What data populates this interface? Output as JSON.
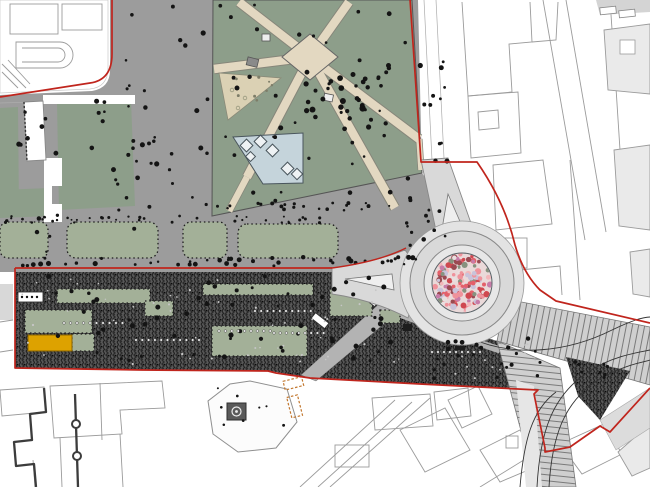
{
  "drawing": {
    "kind": "urban-masterplan-site-plan",
    "width": 650,
    "height": 487
  },
  "palette": {
    "plaza": "#9c9c9c",
    "lawn": "#8d9e8a",
    "panel": "#a3b098",
    "beige": "#e3d8c1",
    "tan": "#dbd1b4",
    "blue": "#c5d4db",
    "road": "#d9d9d9",
    "apron": "#e7e7e7",
    "sidewalk": "#e3e3e3",
    "grove": "#585858",
    "red": "#c0251d",
    "orange": "#dda200",
    "line": "#9b9b9b",
    "dark": "#3c3c3c",
    "pathgray": "#b3b3b3",
    "hatch": "#cfcfcf"
  },
  "roundabout": {
    "cx": 462,
    "cy": 283,
    "r_sidewalk": 62,
    "r_road": 52,
    "r_apron": 38,
    "r_mosaic": 30,
    "mosaic": {
      "seed": 11,
      "count": 155,
      "base": "#ead9d9",
      "colors": [
        "#e4606a",
        "#ef929b",
        "#cf4850",
        "#c9c3da",
        "#87927f",
        "#e9dfdf",
        "#c77ca8",
        "#f3b6ba",
        "#9a4a52"
      ]
    }
  },
  "vegetation_regions": [
    {
      "name": "plaza-north-strip",
      "x": 114,
      "y": 6,
      "w": 94,
      "h": 205,
      "count": 26,
      "seed": 1
    },
    {
      "name": "tree-row-south",
      "x": 20,
      "y": 257,
      "w": 400,
      "h": 9,
      "count": 46,
      "seed": 2
    },
    {
      "name": "garden-scatter",
      "x": 220,
      "y": 4,
      "w": 192,
      "h": 198,
      "count": 48,
      "seed": 3
    },
    {
      "name": "garden-center-cluster",
      "x": 300,
      "y": 60,
      "w": 85,
      "h": 52,
      "count": 24,
      "seed": 4,
      "rmin": 1.6,
      "rmax": 3.2
    },
    {
      "name": "left-lawns",
      "x": 4,
      "y": 100,
      "w": 152,
      "h": 152,
      "count": 32,
      "seed": 5
    },
    {
      "name": "hedge-row",
      "x": 4,
      "y": 216,
      "w": 334,
      "h": 7,
      "count": 40,
      "seed": 6,
      "rmin": 0.9,
      "rmax": 1.6
    },
    {
      "name": "right-plaza-strip",
      "x": 420,
      "y": 55,
      "w": 28,
      "h": 170,
      "count": 13,
      "seed": 7
    },
    {
      "name": "roundabout-nw-cluster",
      "x": 405,
      "y": 198,
      "w": 42,
      "h": 55,
      "count": 11,
      "seed": 8
    },
    {
      "name": "grove-dark-flecks",
      "x": 22,
      "y": 276,
      "w": 378,
      "h": 90,
      "count": 62,
      "seed": 9,
      "rmin": 1.4,
      "rmax": 2.6
    },
    {
      "name": "grove-light-flecks",
      "x": 22,
      "y": 276,
      "w": 378,
      "h": 90,
      "count": 52,
      "seed": 10,
      "rmin": 0.7,
      "rmax": 1.2,
      "color": "#c6c6c6"
    },
    {
      "name": "grove-se-flecks",
      "x": 432,
      "y": 338,
      "w": 110,
      "h": 44,
      "count": 22,
      "seed": 15,
      "rmin": 1.3,
      "rmax": 2.4
    },
    {
      "name": "grove-se-light",
      "x": 432,
      "y": 338,
      "w": 110,
      "h": 44,
      "count": 16,
      "seed": 16,
      "rmin": 0.7,
      "rmax": 1.1,
      "color": "#c6c6c6"
    },
    {
      "name": "grove-wedge-flecks",
      "x": 566,
      "y": 360,
      "w": 56,
      "h": 22,
      "count": 8,
      "seed": 17,
      "rmin": 1.2,
      "rmax": 2.0
    },
    {
      "name": "tan-garden-dots",
      "x": 222,
      "y": 76,
      "w": 50,
      "h": 38,
      "count": 8,
      "seed": 12,
      "rmin": 1.0,
      "rmax": 1.6,
      "color": "#7d7d68"
    },
    {
      "name": "monument-plaza-dots",
      "x": 214,
      "y": 386,
      "w": 80,
      "h": 60,
      "count": 8,
      "seed": 13,
      "rmin": 1.0,
      "rmax": 1.6
    },
    {
      "name": "garden-south-edge-row",
      "x": 214,
      "y": 203,
      "w": 200,
      "h": 8,
      "count": 22,
      "seed": 14,
      "rmin": 1.0,
      "rmax": 2.0
    }
  ],
  "dot_rows": [
    {
      "name": "trunk-row-1",
      "x": 64,
      "y": 323,
      "n": 10,
      "dx": 6.5
    },
    {
      "name": "trunk-row-2",
      "x": 219,
      "y": 331,
      "n": 9,
      "dx": 6.4
    },
    {
      "name": "trunk-row-3",
      "x": 255,
      "y": 311,
      "n": 10,
      "dx": 6.2
    },
    {
      "name": "trunk-row-4",
      "x": 274,
      "y": 333,
      "n": 9,
      "dx": 6.2
    },
    {
      "name": "trunk-row-5",
      "x": 136,
      "y": 340,
      "n": 11,
      "dx": 6.3
    },
    {
      "name": "trunk-row-6",
      "x": 432,
      "y": 352,
      "n": 9,
      "dx": 6.0
    }
  ]
}
